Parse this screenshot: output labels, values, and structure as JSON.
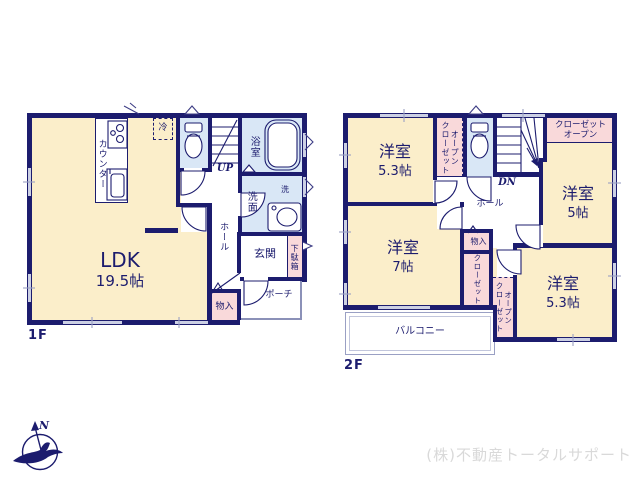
{
  "colors": {
    "wall_navy": "#1c1c6e",
    "room_cream": "#fbeeca",
    "wet_room_blue": "#d9e7f6",
    "closet_pink": "#f9d9da",
    "window_gray": "#ccd0e4",
    "watermark_gray": "#d9d9d9"
  },
  "floor1": {
    "label": "1F",
    "ldk": {
      "name": "LDK",
      "size": "19.5帖"
    },
    "counter": "カウンター",
    "fridge": "冷",
    "stairs_up": "UP",
    "bath": "浴室",
    "laundry": "洗",
    "washroom": "洗面",
    "hall": "ホール",
    "entrance": "玄関",
    "shoe_cabinet": "下駄箱",
    "porch": "ポーチ",
    "storage": "物入"
  },
  "floor2": {
    "label": "2F",
    "bedroom_nw": {
      "name": "洋室",
      "size": "5.3帖"
    },
    "open_closet_nw": "オープン\nクローゼット",
    "closet_ne": "クローゼット\nオープン",
    "stairs_down": "DN",
    "bedroom_e": {
      "name": "洋室",
      "size": "5帖"
    },
    "hall": "ホール",
    "storage": "物入",
    "bedroom_w": {
      "name": "洋室",
      "size": "7帖"
    },
    "closet_center": "クローゼット",
    "open_closet_s": "オープン\nクローゼット",
    "bedroom_se": {
      "name": "洋室",
      "size": "5.3帖"
    },
    "balcony": "バルコニー"
  },
  "compass": {
    "north_label": "N"
  },
  "watermark": "(株)不動産トータルサポート"
}
